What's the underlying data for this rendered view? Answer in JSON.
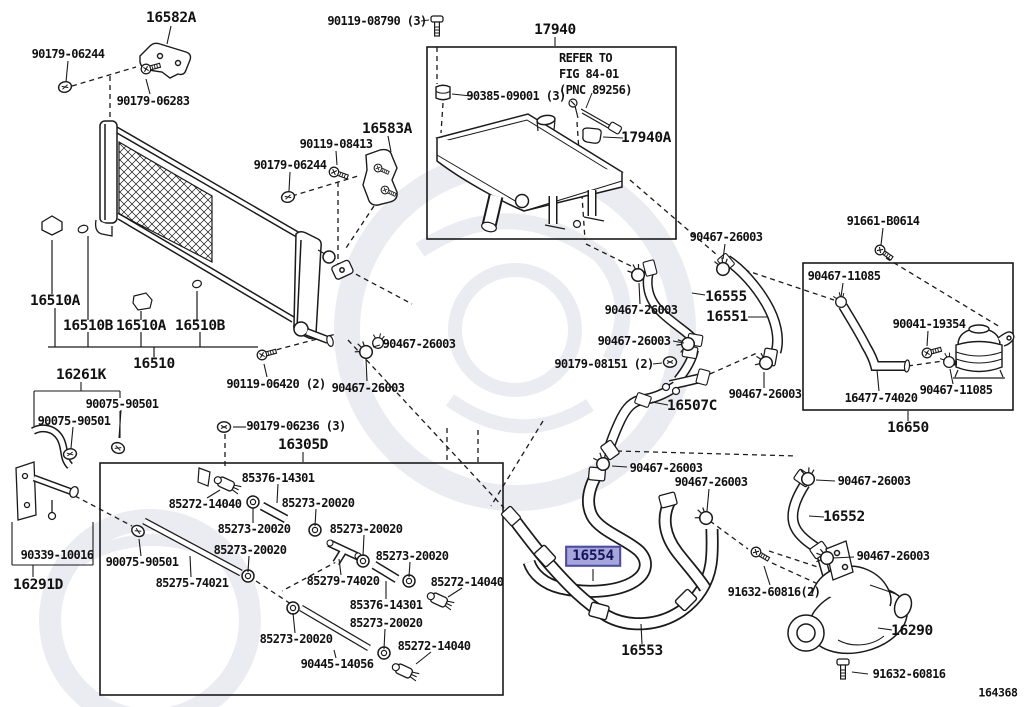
{
  "diagram": {
    "code": "164368",
    "highlighted_part": "16554",
    "note_lines": [
      "REFER TO",
      "FIG 84-01",
      "(PNC 89256)"
    ],
    "colors": {
      "line": "#1a1a1a",
      "background": "#ffffff",
      "highlight_bg": "#a6a6da",
      "highlight_border": "#4a4aa8",
      "highlight_text": "#14145c",
      "watermark": "#ebebf2"
    },
    "labels": [
      {
        "text": "16582A",
        "x": 171,
        "y": 18,
        "size": "lg"
      },
      {
        "text": "17940",
        "x": 555,
        "y": 30,
        "size": "lg"
      },
      {
        "text": "16583A",
        "x": 387,
        "y": 129,
        "size": "lg"
      },
      {
        "text": "17940A",
        "x": 646,
        "y": 138,
        "size": "lg"
      },
      {
        "text": "16555",
        "x": 726,
        "y": 297,
        "size": "lg"
      },
      {
        "text": "16551",
        "x": 727,
        "y": 317,
        "size": "lg"
      },
      {
        "text": "16507C",
        "x": 692,
        "y": 406,
        "size": "lg"
      },
      {
        "text": "16510A",
        "x": 55,
        "y": 301,
        "size": "lg"
      },
      {
        "text": "16510B",
        "x": 88,
        "y": 326,
        "size": "lg"
      },
      {
        "text": "16510A",
        "x": 141,
        "y": 326,
        "size": "lg"
      },
      {
        "text": "16510B",
        "x": 200,
        "y": 326,
        "size": "lg"
      },
      {
        "text": "16510",
        "x": 154,
        "y": 364,
        "size": "lg"
      },
      {
        "text": "16261K",
        "x": 81,
        "y": 375,
        "size": "lg"
      },
      {
        "text": "16305D",
        "x": 303,
        "y": 445,
        "size": "lg"
      },
      {
        "text": "16291D",
        "x": 38,
        "y": 585,
        "size": "lg"
      },
      {
        "text": "16554",
        "x": 593,
        "y": 556,
        "size": "lg",
        "highlighted": true
      },
      {
        "text": "16553",
        "x": 642,
        "y": 651,
        "size": "lg"
      },
      {
        "text": "16552",
        "x": 844,
        "y": 517,
        "size": "lg"
      },
      {
        "text": "16290",
        "x": 912,
        "y": 631,
        "size": "lg"
      },
      {
        "text": "16650",
        "x": 908,
        "y": 428,
        "size": "lg"
      },
      {
        "text": "90179-06244",
        "x": 68,
        "y": 54,
        "size": "sm"
      },
      {
        "text": "90179-06283",
        "x": 153,
        "y": 101,
        "size": "sm"
      },
      {
        "text": "90119-08790 (3)",
        "x": 377,
        "y": 21,
        "size": "sm"
      },
      {
        "text": "90385-09001 (3)",
        "x": 516,
        "y": 96,
        "size": "sm"
      },
      {
        "text": "90119-08413",
        "x": 336,
        "y": 144,
        "size": "sm"
      },
      {
        "text": "90179-06244",
        "x": 290,
        "y": 165,
        "size": "sm"
      },
      {
        "text": "91661-B0614",
        "x": 883,
        "y": 221,
        "size": "sm"
      },
      {
        "text": "90467-26003",
        "x": 726,
        "y": 237,
        "size": "sm"
      },
      {
        "text": "90467-11085",
        "x": 844,
        "y": 276,
        "size": "sm"
      },
      {
        "text": "90041-19354",
        "x": 929,
        "y": 324,
        "size": "sm"
      },
      {
        "text": "90467-11085",
        "x": 956,
        "y": 390,
        "size": "sm"
      },
      {
        "text": "16477-74020",
        "x": 881,
        "y": 398,
        "size": "sm"
      },
      {
        "text": "90467-26003",
        "x": 641,
        "y": 310,
        "size": "sm"
      },
      {
        "text": "90467-26003",
        "x": 634,
        "y": 341,
        "size": "sm"
      },
      {
        "text": "90179-08151 (2)",
        "x": 604,
        "y": 364,
        "size": "sm"
      },
      {
        "text": "90467-26003",
        "x": 765,
        "y": 394,
        "size": "sm"
      },
      {
        "text": "90119-06420 (2)",
        "x": 276,
        "y": 384,
        "size": "sm"
      },
      {
        "text": "90467-26003",
        "x": 368,
        "y": 388,
        "size": "sm"
      },
      {
        "text": "90467-26003",
        "x": 419,
        "y": 344,
        "size": "sm"
      },
      {
        "text": "90179-06236 (3)",
        "x": 296,
        "y": 426,
        "size": "sm"
      },
      {
        "text": "90075-90501",
        "x": 122,
        "y": 404,
        "size": "sm"
      },
      {
        "text": "90075-90501",
        "x": 74,
        "y": 421,
        "size": "sm"
      },
      {
        "text": "90339-10016",
        "x": 57,
        "y": 555,
        "size": "sm"
      },
      {
        "text": "90075-90501",
        "x": 142,
        "y": 562,
        "size": "sm"
      },
      {
        "text": "85272-14040",
        "x": 205,
        "y": 504,
        "size": "sm"
      },
      {
        "text": "85376-14301",
        "x": 278,
        "y": 478,
        "size": "sm"
      },
      {
        "text": "85273-20020",
        "x": 318,
        "y": 503,
        "size": "sm"
      },
      {
        "text": "85273-20020",
        "x": 254,
        "y": 529,
        "size": "sm"
      },
      {
        "text": "85273-20020",
        "x": 366,
        "y": 529,
        "size": "sm"
      },
      {
        "text": "85273-20020",
        "x": 250,
        "y": 550,
        "size": "sm"
      },
      {
        "text": "85273-20020",
        "x": 412,
        "y": 556,
        "size": "sm"
      },
      {
        "text": "85275-74021",
        "x": 192,
        "y": 583,
        "size": "sm"
      },
      {
        "text": "85279-74020",
        "x": 343,
        "y": 581,
        "size": "sm"
      },
      {
        "text": "85272-14040",
        "x": 467,
        "y": 582,
        "size": "sm"
      },
      {
        "text": "85376-14301",
        "x": 386,
        "y": 605,
        "size": "sm"
      },
      {
        "text": "85273-20020",
        "x": 386,
        "y": 623,
        "size": "sm"
      },
      {
        "text": "85272-14040",
        "x": 434,
        "y": 646,
        "size": "sm"
      },
      {
        "text": "85273-20020",
        "x": 296,
        "y": 639,
        "size": "sm"
      },
      {
        "text": "90445-14056",
        "x": 337,
        "y": 664,
        "size": "sm"
      },
      {
        "text": "90467-26003",
        "x": 666,
        "y": 468,
        "size": "sm"
      },
      {
        "text": "90467-26003",
        "x": 711,
        "y": 482,
        "size": "sm"
      },
      {
        "text": "91632-60816(2)",
        "x": 774,
        "y": 592,
        "size": "sm"
      },
      {
        "text": "90467-26003",
        "x": 874,
        "y": 481,
        "size": "sm"
      },
      {
        "text": "90467-26003",
        "x": 893,
        "y": 556,
        "size": "sm"
      },
      {
        "text": "91632-60816",
        "x": 909,
        "y": 674,
        "size": "sm"
      },
      {
        "text": "REFER TO",
        "x": 559,
        "y": 58,
        "size": "sm",
        "kind": "note"
      },
      {
        "text": "FIG 84-01",
        "x": 559,
        "y": 74,
        "size": "sm",
        "kind": "note"
      },
      {
        "text": "(PNC 89256)",
        "x": 559,
        "y": 90,
        "size": "sm",
        "kind": "note"
      },
      {
        "text": "164368",
        "x": 998,
        "y": 693,
        "size": "sm",
        "kind": "code"
      }
    ]
  }
}
